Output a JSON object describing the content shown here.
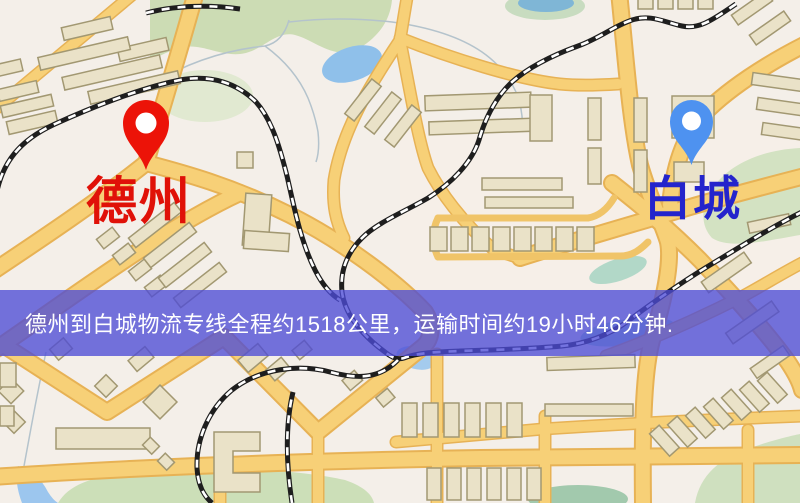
{
  "origin": {
    "label": "德州"
  },
  "destination": {
    "label": "白城"
  },
  "banner": {
    "text": "德州到白城物流专线全程约1518公里，运输时间约19小时46分钟.",
    "distance_text": "约1518公里",
    "duration_text": "约19小时46分钟"
  },
  "colors": {
    "origin_pin": "#ec1308",
    "destination_pin": "#4e92f0",
    "origin_label": "#e01108",
    "destination_label": "#2424cc",
    "banner_bg": "rgba(77,76,214,0.78)",
    "banner_text": "#ffffff"
  }
}
